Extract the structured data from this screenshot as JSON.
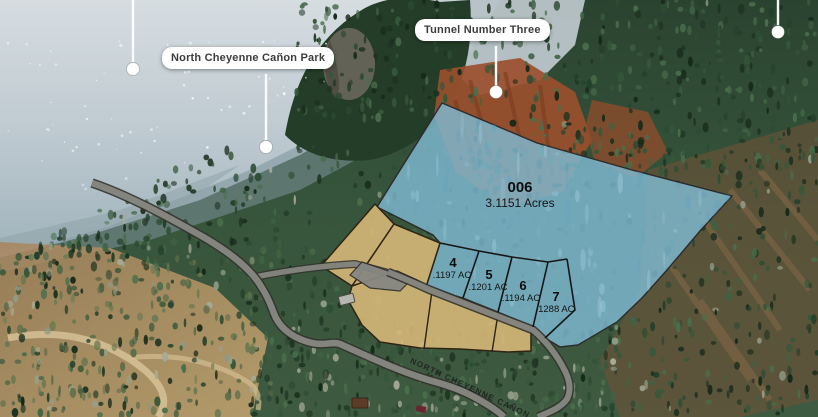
{
  "callouts": {
    "park": {
      "label": "North Cheyenne Cañon Park"
    },
    "tunnel": {
      "label": "Tunnel Number Three"
    }
  },
  "road_label": "NORTH CHEYENNE CAÑON",
  "lots": {
    "main": {
      "number": "006",
      "acreage": "3.1151 Acres"
    },
    "small": [
      {
        "number": "4",
        "acreage": ".1197 AC"
      },
      {
        "number": "5",
        "acreage": ".1201 AC"
      },
      {
        "number": "6",
        "acreage": ".1194 AC"
      },
      {
        "number": "7",
        "acreage": ".1288 AC"
      }
    ]
  },
  "colors": {
    "lot_fill_blue": "#7fbad2",
    "lot_fill_tan": "#d6b878",
    "road_fill": "#878781",
    "road_casing": "#33332e",
    "boundary_line": "#161616"
  }
}
